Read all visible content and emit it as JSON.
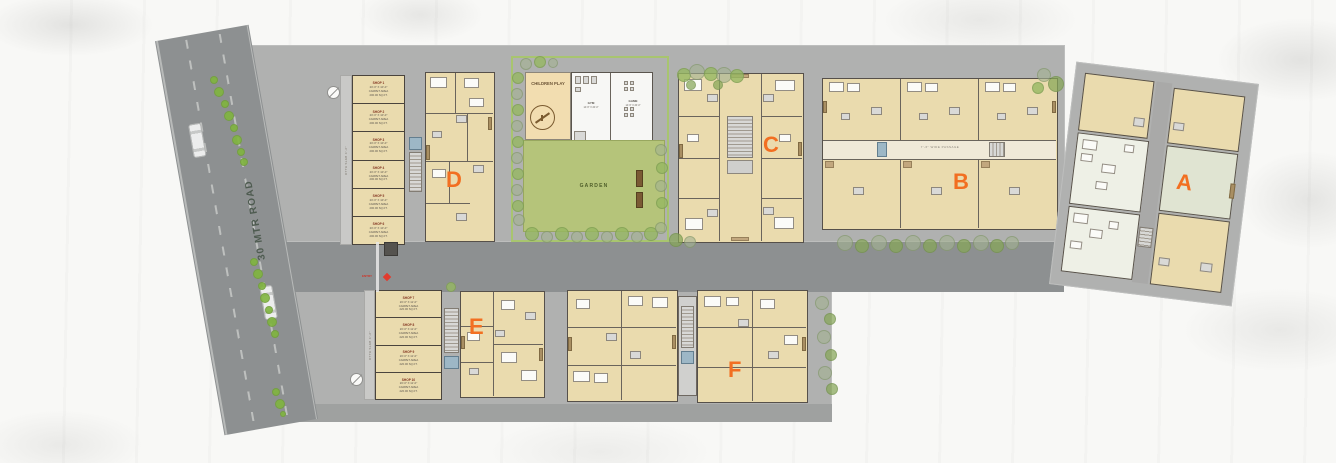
{
  "site": {
    "road_label": "30 MTR ROAD",
    "entry_label": "ENTRY",
    "passage_label": "7'-6\" WIDE PASSAGE",
    "driveway_top_label": "OTTA SLAB 4'-6\"",
    "driveway_bottom_label": "OTTA SLAB 4'-6\""
  },
  "blocks": {
    "a": "A",
    "b": "B",
    "c": "C",
    "d": "D",
    "e": "E",
    "f": "F"
  },
  "garden": {
    "label": "GARDEN",
    "children_play_label": "CHILDREN PLAY"
  },
  "clubhouse": {
    "gym_name": "GYM",
    "gym_dim": "14'-6\" X 20'-0\"",
    "game_name": "GAME",
    "game_dim": "14'-6\" X 20'-0\""
  },
  "shops_top": [
    {
      "name": "SHOP 1",
      "dim": "20'-0\" X 10'-0\"",
      "carpet": "CARPET AREA",
      "area": "200.00 SQ.FT."
    },
    {
      "name": "SHOP 2",
      "dim": "20'-0\" X 10'-0\"",
      "carpet": "CARPET AREA",
      "area": "200.00 SQ.FT."
    },
    {
      "name": "SHOP 3",
      "dim": "20'-0\" X 10'-0\"",
      "carpet": "CARPET AREA",
      "area": "200.00 SQ.FT."
    },
    {
      "name": "SHOP 4",
      "dim": "20'-0\" X 10'-0\"",
      "carpet": "CARPET AREA",
      "area": "200.00 SQ.FT."
    },
    {
      "name": "SHOP 5",
      "dim": "20'-0\" X 10'-0\"",
      "carpet": "CARPET AREA",
      "area": "200.00 SQ.FT."
    },
    {
      "name": "SHOP 6",
      "dim": "20'-0\" X 10'-0\"",
      "carpet": "CARPET AREA",
      "area": "200.00 SQ.FT."
    }
  ],
  "shops_bottom": [
    {
      "name": "SHOP 7",
      "dim": "20'-0\" X 11'-0\"",
      "carpet": "CARPET AREA",
      "area": "220.00 SQ.FT."
    },
    {
      "name": "SHOP 8",
      "dim": "20'-0\" X 11'-0\"",
      "carpet": "CARPET AREA",
      "area": "220.00 SQ.FT."
    },
    {
      "name": "SHOP 9",
      "dim": "20'-0\" X 11'-0\"",
      "carpet": "CARPET AREA",
      "area": "220.00 SQ.FT."
    },
    {
      "name": "SHOP 10",
      "dim": "20'-0\" X 11'-0\"",
      "carpet": "CARPET AREA",
      "area": "220.00 SQ.FT."
    }
  ],
  "colors": {
    "accent_orange": "#f26f21",
    "plate_gray": "#b0b1b0",
    "road_gray": "#8d9091",
    "building_beige": "#eadbae",
    "garden_green": "#b5c47a",
    "tree_green": "#7fb53e",
    "sage_unit": "#e0e4d2"
  }
}
